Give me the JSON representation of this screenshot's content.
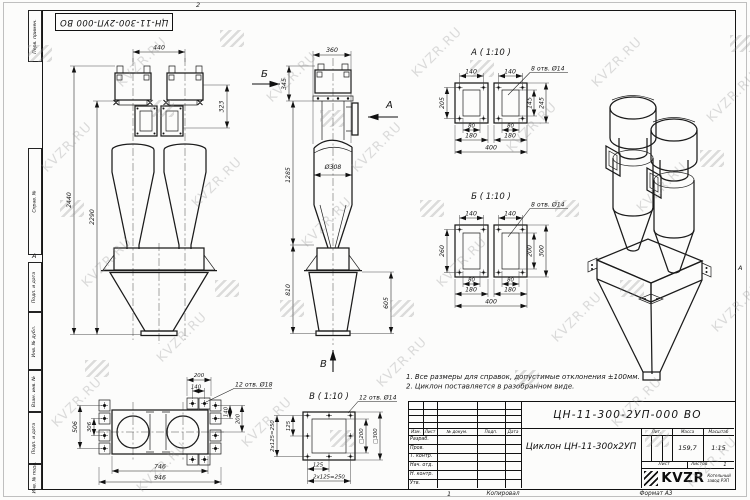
{
  "watermark": {
    "text": "KVZR.RU"
  },
  "frame": {
    "stamp": "ЦН-11-300-2УП-000 ВО",
    "zone_top": "2",
    "zone_left": "А",
    "zone_right": "А",
    "zone_bottom": "1",
    "margin_labels": [
      "Перв. примен.",
      "Справ. №",
      "Подп. и дата",
      "Инв. № дубл.",
      "Взам. инв. №",
      "Подп. и дата",
      "Инв. № подл."
    ]
  },
  "notes": {
    "line1": "1. Все размеры для справок, допустимые отклонения ±100мм.",
    "line2": "2. Циклон поставляется в разобранном виде."
  },
  "views": {
    "front": {
      "d440": "440",
      "d323": "323",
      "d2440": "2440",
      "d2290": "2290"
    },
    "side": {
      "label_b": "Б",
      "label_a": "А",
      "label_v": "В",
      "d360": "360",
      "d345": "345",
      "dia308": "Ø308",
      "d1285": "1285",
      "d810": "810",
      "d605": "605"
    },
    "detail_a": {
      "title": "А ( 1:10 )",
      "holes": "8 отв. Ø14",
      "d140": "140",
      "d205": "205",
      "d145": "145",
      "d245": "245",
      "d80": "80",
      "d180": "180",
      "d400": "400"
    },
    "detail_b": {
      "title": "Б ( 1:10 )",
      "holes": "8 отв. Ø14",
      "d140": "140",
      "d260": "260",
      "d200": "200",
      "d300": "300",
      "d80": "80",
      "d180": "180",
      "d400": "400"
    },
    "plan": {
      "holes": "12 отв. Ø18",
      "d200": "200",
      "d140": "140",
      "d140r": "140",
      "d200r": "200",
      "d506": "506",
      "d306": "306",
      "d746": "746",
      "d946": "946"
    },
    "detail_v": {
      "title": "В ( 1:10 )",
      "holes": "12 отв. Ø14",
      "d125": "125",
      "d250": "2х125=250",
      "sq200": "□200",
      "sq300": "□300"
    }
  },
  "title_block": {
    "doc_number": "ЦН-11-300-2УП-000 ВО",
    "product_title": "Циклон ЦН-11-300х2УП",
    "headers": {
      "izm": "Изм.",
      "list": "Лист",
      "doc": "№ докум.",
      "podp": "Подп.",
      "data": "Дата"
    },
    "rows": [
      "Разраб.",
      "Пров.",
      "Т. контр.",
      "Нач. отд.",
      "Н. контр.",
      "Утв."
    ],
    "lit_label": "Лит.",
    "mass_label": "Масса",
    "scale_label": "Масштаб",
    "mass": "159,7",
    "scale": "1:15",
    "sheet_label": "Лист",
    "sheets_label": "Листов",
    "sheets_value": "1",
    "logo_text": "KVZR",
    "logo_sub1": "Котельный",
    "logo_sub2": "завод РЭП",
    "copied": "Копировал",
    "format": "Формат А3"
  }
}
